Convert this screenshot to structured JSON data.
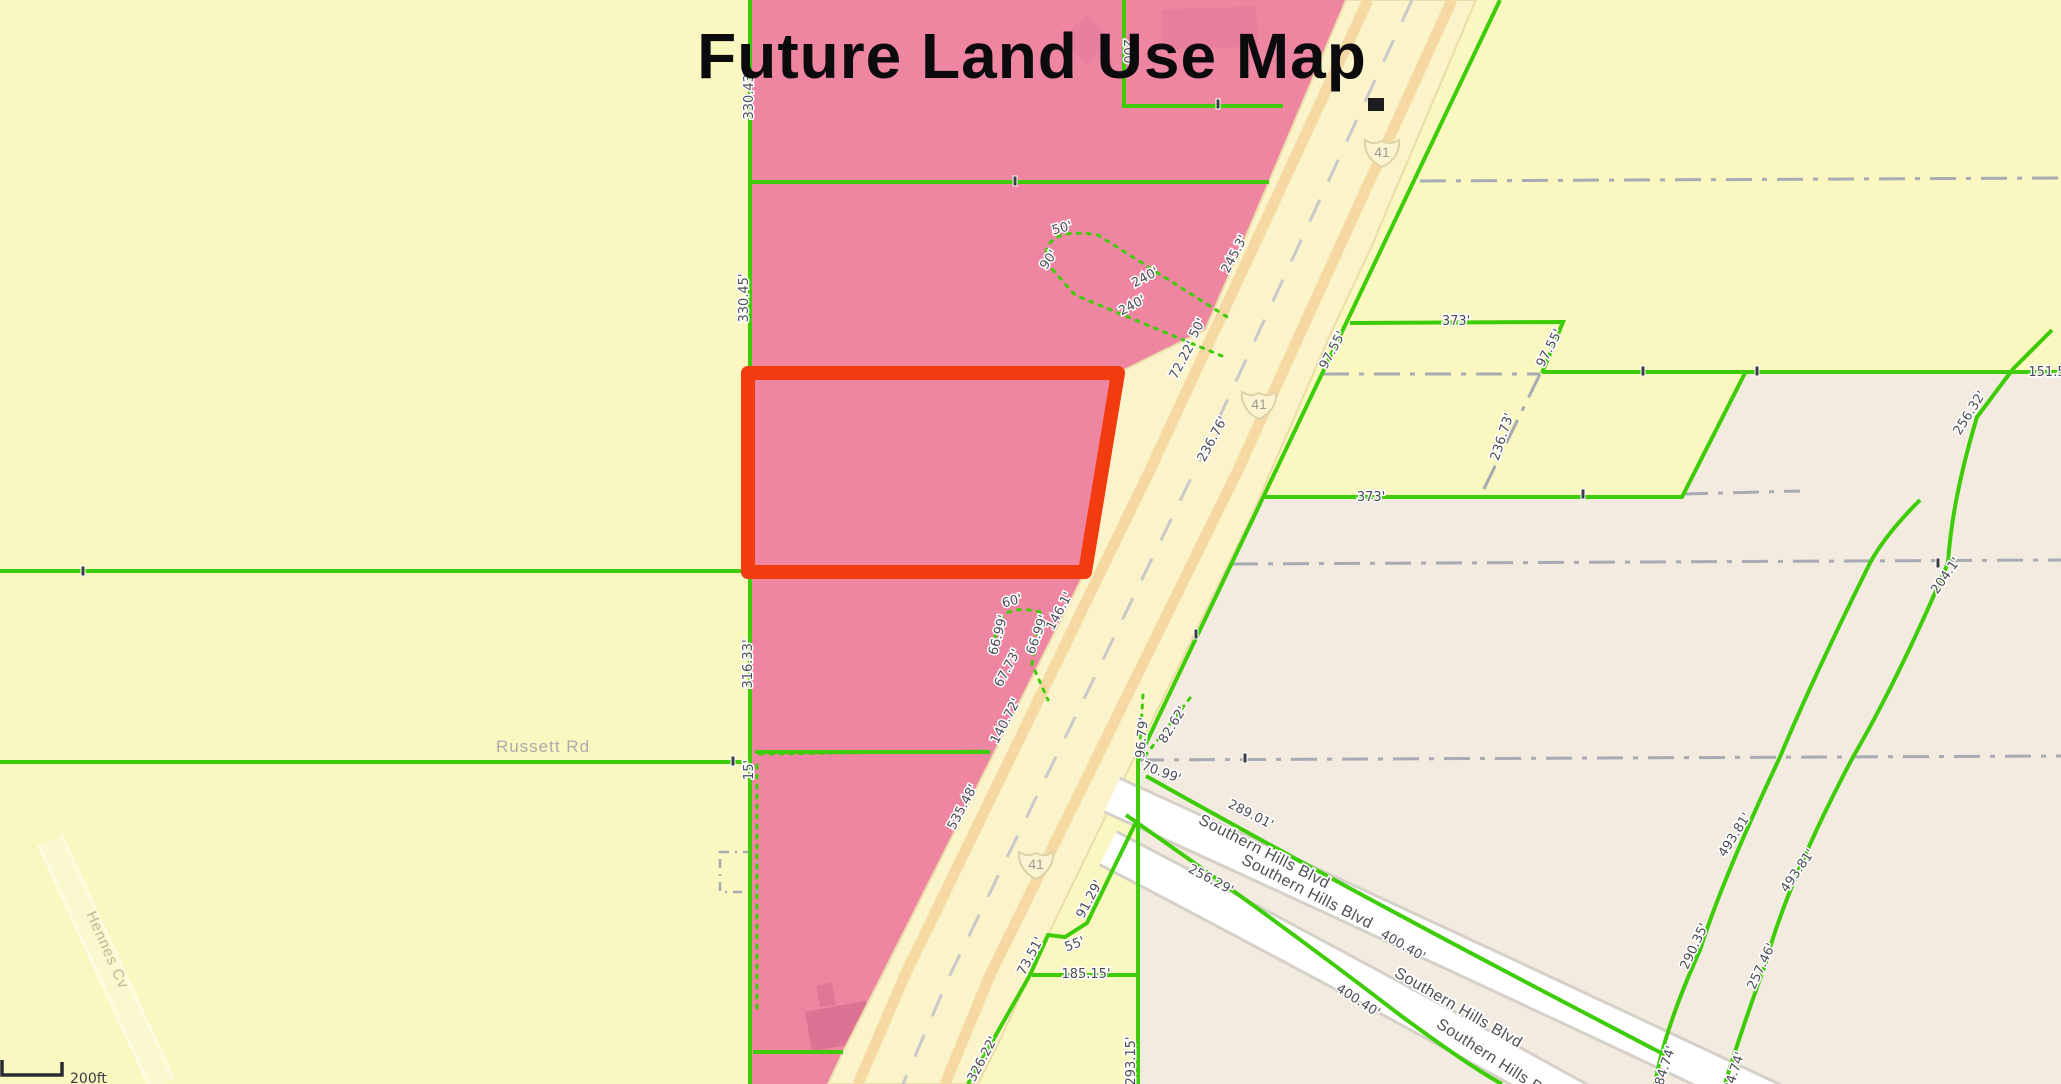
{
  "title": "Future Land Use Map",
  "streets": {
    "russett_rd": "Russett Rd",
    "hennes_cv": "Hennes Cv",
    "southern_hills_blvd": "Southern Hills Blvd"
  },
  "highway_shield": "41",
  "scale_bar_label": "200ft",
  "colors": {
    "landuse_pink": "#EE86A2",
    "landuse_yellow": "#FAF8C0",
    "landuse_beige": "#F3EBDF",
    "parcel_line_green": "#3FCC08",
    "highlight_red": "#F23C10",
    "road_fill": "#FBF3C9",
    "road_stripe": "#F6D9A2",
    "section_line_gray": "#A7ABB3"
  },
  "dims": [
    "330.43'",
    "330.45'",
    "316.33'",
    "15'",
    "200'",
    "50'",
    "90'",
    "240'",
    "240'",
    "50'",
    "72.22'",
    "245.3'",
    "60'",
    "66.99'",
    "66.99'",
    "67.73'",
    "146.1'",
    "140.72'",
    "535.48'",
    "91.29'",
    "55'",
    "73.51'",
    "185.15'",
    "326.22'",
    "96.79'",
    "82.62'",
    "70.99'",
    "289.01'",
    "256.29'",
    "400.40'",
    "400.40'",
    "293.15'",
    "236.76'",
    "97.55'",
    "97.55'",
    "373'",
    "373'",
    "236.73'",
    "151.5",
    "256.32'",
    "204.1'",
    "493.81'",
    "290.35'",
    "84.74'",
    "493.81'",
    "257.46'",
    "84.74'"
  ]
}
